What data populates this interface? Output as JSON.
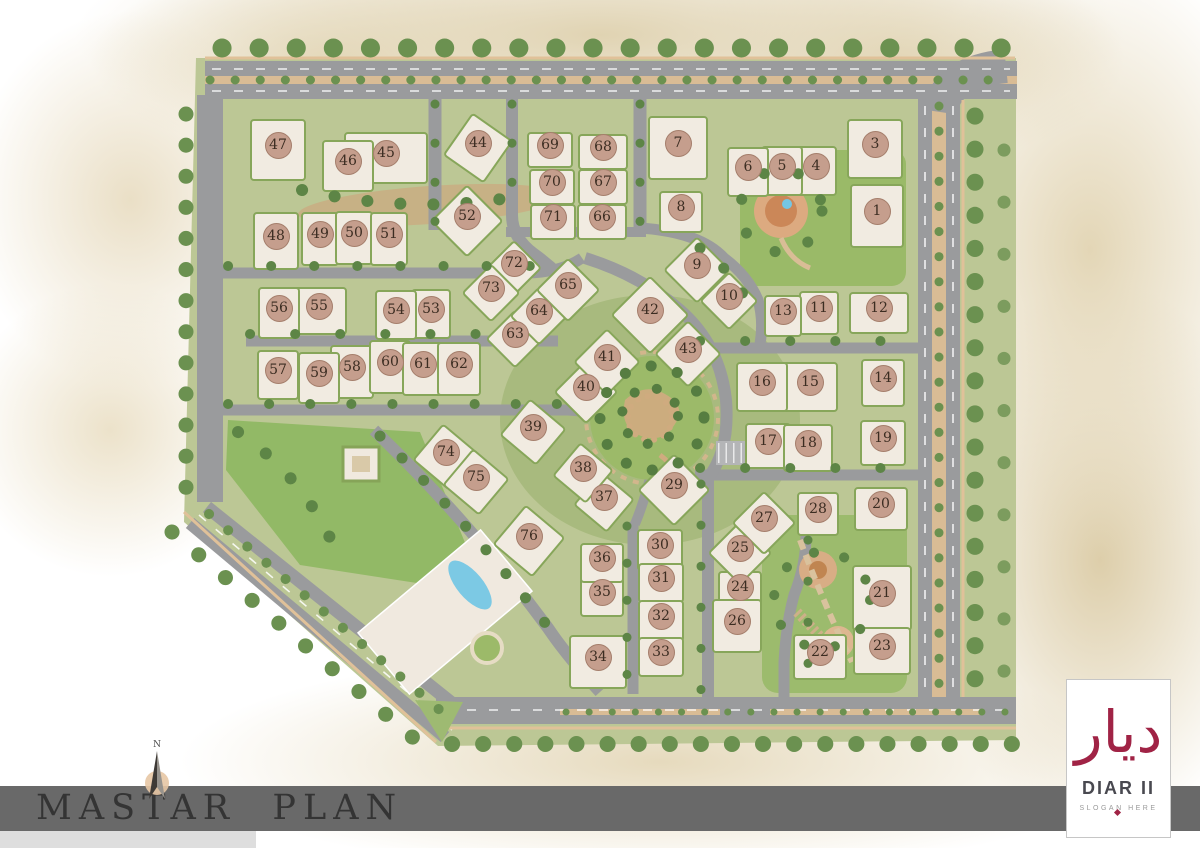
{
  "title_bar": {
    "title": "MASTAR  PLAN"
  },
  "compass": {
    "label": "N"
  },
  "logo": {
    "arabic": "ديار",
    "name": "DIAR II",
    "slogan": "SLOGAN HERE"
  },
  "colors": {
    "marker_bg": "#c59e8d",
    "marker_text": "#3c2d22",
    "banner": "#696969",
    "logo_maroon": "#a02345",
    "road": "#9a9b9d",
    "lawn": "#9cba69",
    "building": "#f1ebe1",
    "hedge": "#87a65a",
    "sand": "#e2d6b8",
    "pool_blue": "#7cc9e4"
  },
  "plan": {
    "buildings": [
      {
        "n": 1,
        "x": 877,
        "y": 211,
        "w": 50,
        "h": 60
      },
      {
        "n": 3,
        "x": 875,
        "y": 144,
        "w": 52,
        "h": 56
      },
      {
        "n": 4,
        "x": 816,
        "y": 166,
        "w": 38,
        "h": 46
      },
      {
        "n": 5,
        "x": 782,
        "y": 166,
        "w": 38,
        "h": 46
      },
      {
        "n": 6,
        "x": 748,
        "y": 167,
        "w": 38,
        "h": 46
      },
      {
        "n": 7,
        "x": 678,
        "y": 143,
        "w": 56,
        "h": 60
      },
      {
        "n": 8,
        "x": 681,
        "y": 207,
        "w": 40,
        "h": 38
      },
      {
        "n": 9,
        "x": 697,
        "y": 265,
        "w": 44,
        "h": 44,
        "rot": 45
      },
      {
        "n": 10,
        "x": 729,
        "y": 296,
        "w": 38,
        "h": 38,
        "rot": 45
      },
      {
        "n": 11,
        "x": 819,
        "y": 308,
        "w": 36,
        "h": 40
      },
      {
        "n": 12,
        "x": 879,
        "y": 308,
        "w": 56,
        "h": 38
      },
      {
        "n": 13,
        "x": 783,
        "y": 311,
        "w": 34,
        "h": 38
      },
      {
        "n": 14,
        "x": 883,
        "y": 378,
        "w": 40,
        "h": 44
      },
      {
        "n": 15,
        "x": 810,
        "y": 382,
        "w": 52,
        "h": 46
      },
      {
        "n": 16,
        "x": 762,
        "y": 382,
        "w": 48,
        "h": 46
      },
      {
        "n": 17,
        "x": 768,
        "y": 441,
        "w": 42,
        "h": 42
      },
      {
        "n": 18,
        "x": 808,
        "y": 443,
        "w": 46,
        "h": 44
      },
      {
        "n": 19,
        "x": 883,
        "y": 438,
        "w": 42,
        "h": 42
      },
      {
        "n": 20,
        "x": 881,
        "y": 504,
        "w": 50,
        "h": 40
      },
      {
        "n": 21,
        "x": 882,
        "y": 593,
        "w": 56,
        "h": 62
      },
      {
        "n": 22,
        "x": 820,
        "y": 652,
        "w": 50,
        "h": 42
      },
      {
        "n": 23,
        "x": 882,
        "y": 646,
        "w": 54,
        "h": 44
      },
      {
        "n": 24,
        "x": 740,
        "y": 587,
        "w": 40,
        "h": 38
      },
      {
        "n": 25,
        "x": 740,
        "y": 548,
        "w": 42,
        "h": 42,
        "rot": 45
      },
      {
        "n": 26,
        "x": 737,
        "y": 621,
        "w": 46,
        "h": 50
      },
      {
        "n": 27,
        "x": 764,
        "y": 518,
        "w": 42,
        "h": 42,
        "rot": 45
      },
      {
        "n": 28,
        "x": 818,
        "y": 509,
        "w": 38,
        "h": 40
      },
      {
        "n": 29,
        "x": 674,
        "y": 485,
        "w": 48,
        "h": 48,
        "rot": 45
      },
      {
        "n": 30,
        "x": 660,
        "y": 545,
        "w": 42,
        "h": 38
      },
      {
        "n": 31,
        "x": 661,
        "y": 578,
        "w": 42,
        "h": 36
      },
      {
        "n": 32,
        "x": 661,
        "y": 616,
        "w": 42,
        "h": 38
      },
      {
        "n": 33,
        "x": 661,
        "y": 652,
        "w": 42,
        "h": 36
      },
      {
        "n": 34,
        "x": 598,
        "y": 657,
        "w": 54,
        "h": 50
      },
      {
        "n": 35,
        "x": 602,
        "y": 592,
        "w": 40,
        "h": 36
      },
      {
        "n": 36,
        "x": 602,
        "y": 558,
        "w": 40,
        "h": 36
      },
      {
        "n": 37,
        "x": 604,
        "y": 497,
        "w": 40,
        "h": 40,
        "rot": 40
      },
      {
        "n": 38,
        "x": 583,
        "y": 468,
        "w": 40,
        "h": 40,
        "rot": 40
      },
      {
        "n": 39,
        "x": 533,
        "y": 427,
        "w": 44,
        "h": 44,
        "rot": 40
      },
      {
        "n": 40,
        "x": 586,
        "y": 387,
        "w": 42,
        "h": 42,
        "rot": 45
      },
      {
        "n": 41,
        "x": 607,
        "y": 357,
        "w": 44,
        "h": 44,
        "rot": 45
      },
      {
        "n": 42,
        "x": 650,
        "y": 310,
        "w": 52,
        "h": 52,
        "rot": 45
      },
      {
        "n": 43,
        "x": 688,
        "y": 349,
        "w": 44,
        "h": 44,
        "rot": 45
      },
      {
        "n": 44,
        "x": 478,
        "y": 143,
        "w": 46,
        "h": 48,
        "rot": 35
      },
      {
        "n": 45,
        "x": 386,
        "y": 153,
        "w": 80,
        "h": 48
      },
      {
        "n": 46,
        "x": 348,
        "y": 161,
        "w": 48,
        "h": 48
      },
      {
        "n": 47,
        "x": 278,
        "y": 145,
        "w": 52,
        "h": 58
      },
      {
        "n": 48,
        "x": 276,
        "y": 236,
        "w": 42,
        "h": 54
      },
      {
        "n": 49,
        "x": 320,
        "y": 234,
        "w": 34,
        "h": 50
      },
      {
        "n": 50,
        "x": 354,
        "y": 233,
        "w": 34,
        "h": 50
      },
      {
        "n": 51,
        "x": 389,
        "y": 234,
        "w": 34,
        "h": 50
      },
      {
        "n": 52,
        "x": 467,
        "y": 216,
        "w": 48,
        "h": 48,
        "rot": 45
      },
      {
        "n": 53,
        "x": 431,
        "y": 309,
        "w": 36,
        "h": 46
      },
      {
        "n": 54,
        "x": 396,
        "y": 310,
        "w": 38,
        "h": 46
      },
      {
        "n": 55,
        "x": 319,
        "y": 306,
        "w": 52,
        "h": 44
      },
      {
        "n": 56,
        "x": 279,
        "y": 308,
        "w": 38,
        "h": 48
      },
      {
        "n": 57,
        "x": 278,
        "y": 370,
        "w": 38,
        "h": 46
      },
      {
        "n": 58,
        "x": 352,
        "y": 367,
        "w": 40,
        "h": 50
      },
      {
        "n": 59,
        "x": 319,
        "y": 373,
        "w": 38,
        "h": 48
      },
      {
        "n": 60,
        "x": 390,
        "y": 362,
        "w": 38,
        "h": 50
      },
      {
        "n": 61,
        "x": 423,
        "y": 364,
        "w": 38,
        "h": 50
      },
      {
        "n": 62,
        "x": 459,
        "y": 364,
        "w": 40,
        "h": 50
      },
      {
        "n": 63,
        "x": 515,
        "y": 334,
        "w": 38,
        "h": 38,
        "rot": 45
      },
      {
        "n": 64,
        "x": 539,
        "y": 311,
        "w": 38,
        "h": 38,
        "rot": 45
      },
      {
        "n": 65,
        "x": 568,
        "y": 285,
        "w": 42,
        "h": 42,
        "rot": 45
      },
      {
        "n": 66,
        "x": 602,
        "y": 217,
        "w": 46,
        "h": 32
      },
      {
        "n": 67,
        "x": 603,
        "y": 182,
        "w": 46,
        "h": 32
      },
      {
        "n": 68,
        "x": 603,
        "y": 147,
        "w": 46,
        "h": 32
      },
      {
        "n": 69,
        "x": 550,
        "y": 145,
        "w": 42,
        "h": 32
      },
      {
        "n": 70,
        "x": 552,
        "y": 182,
        "w": 42,
        "h": 32
      },
      {
        "n": 71,
        "x": 553,
        "y": 217,
        "w": 42,
        "h": 32
      },
      {
        "n": 72,
        "x": 514,
        "y": 263,
        "w": 36,
        "h": 36,
        "rot": 45
      },
      {
        "n": 73,
        "x": 491,
        "y": 288,
        "w": 38,
        "h": 38,
        "rot": 45
      },
      {
        "n": 74,
        "x": 446,
        "y": 452,
        "w": 44,
        "h": 44,
        "rot": 40
      },
      {
        "n": 75,
        "x": 476,
        "y": 477,
        "w": 44,
        "h": 44,
        "rot": 40
      },
      {
        "n": 76,
        "x": 529,
        "y": 536,
        "w": 48,
        "h": 48,
        "rot": 40
      }
    ]
  }
}
